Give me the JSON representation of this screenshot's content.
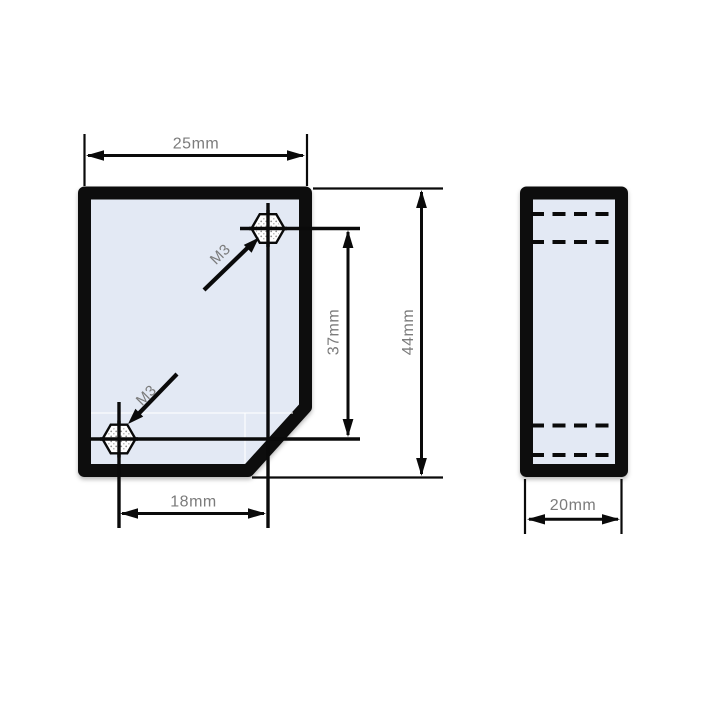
{
  "canvas": {
    "width": 720,
    "height": 720,
    "background": "#ffffff"
  },
  "colors": {
    "part_fill": "#e3e9f4",
    "stroke": "#0a0a0a",
    "dim_text": "#7b7b7b"
  },
  "front_view": {
    "dim_top_width": {
      "label": "25mm",
      "value_mm": 25
    },
    "dim_bottom_width": {
      "label": "18mm",
      "value_mm": 18
    },
    "dim_hole_spacing": {
      "label": "37mm",
      "value_mm": 37
    },
    "dim_height": {
      "label": "44mm",
      "value_mm": 44
    },
    "hole_top": {
      "label": "M3"
    },
    "hole_bottom": {
      "label": "M3"
    }
  },
  "side_view": {
    "dim_depth": {
      "label": "20mm",
      "value_mm": 20
    }
  }
}
